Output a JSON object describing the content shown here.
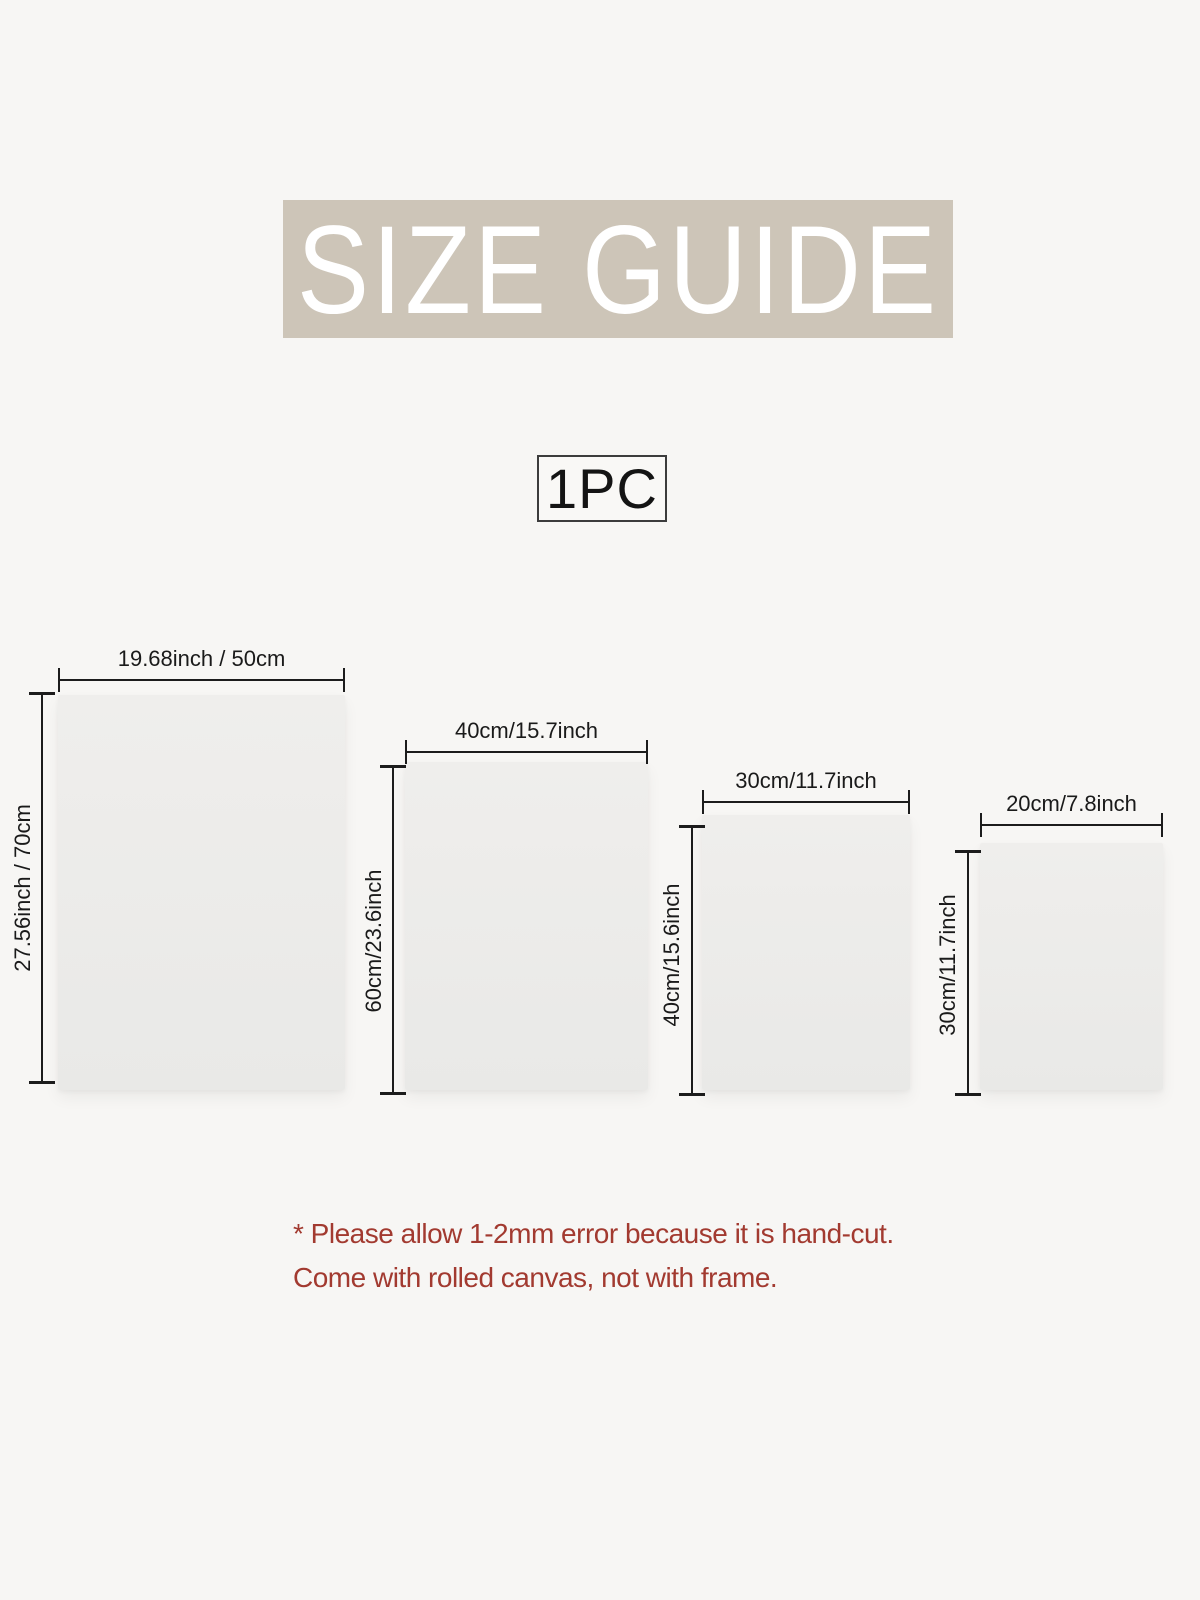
{
  "banner": {
    "title": "SIZE GUIDE"
  },
  "quantity": {
    "label": "1PC"
  },
  "canvases": [
    {
      "name": "canvas-50x70",
      "width_label": "19.68inch / 50cm",
      "height_label": "27.56inch / 70cm"
    },
    {
      "name": "canvas-40x60",
      "width_label": "40cm/15.7inch",
      "height_label": "60cm/23.6inch"
    },
    {
      "name": "canvas-30x40",
      "width_label": "30cm/11.7inch",
      "height_label": "40cm/15.6inch"
    },
    {
      "name": "canvas-20x30",
      "width_label": "20cm/7.8inch",
      "height_label": "30cm/11.7inch"
    }
  ],
  "note": {
    "line1": "* Please allow 1-2mm error because it is hand-cut.",
    "line2": "Come with rolled canvas, not with frame."
  },
  "colors": {
    "page_bg": "#f7f6f4",
    "banner_bg": "#cdc5b8",
    "banner_text": "#ffffff",
    "canvas_fill": "#ececea",
    "dimension_line": "#1c1c1c",
    "note_text": "#a23a30"
  }
}
